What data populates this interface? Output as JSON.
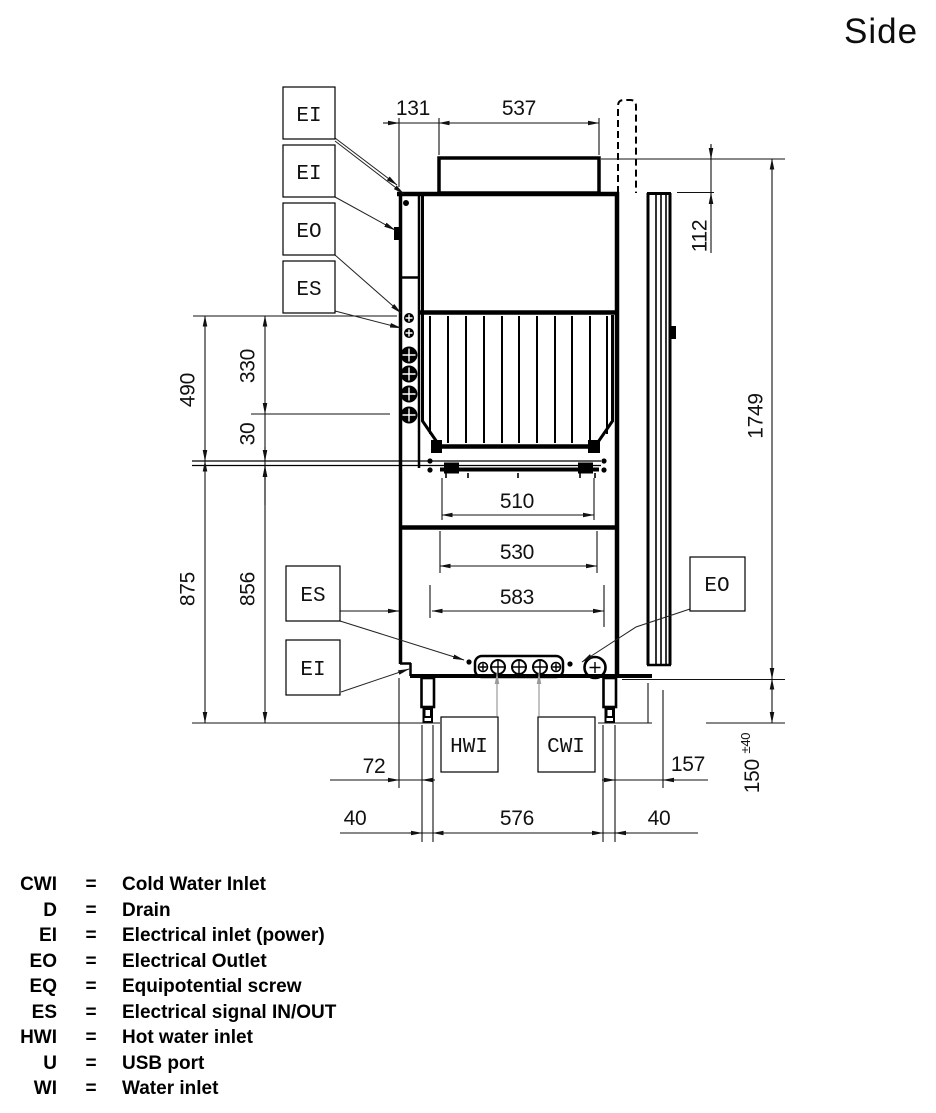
{
  "title": "Side",
  "dims": {
    "d131": "131",
    "d537": "537",
    "d112": "112",
    "d1749": "1749",
    "d490": "490",
    "d330": "330",
    "d30": "30",
    "d875": "875",
    "d856": "856",
    "d510": "510",
    "d530": "530",
    "d583": "583",
    "d107": "107",
    "d72": "72",
    "d157": "157",
    "d150": "150",
    "d150tol": "±40",
    "d40l": "40",
    "d576": "576",
    "d40r": "40"
  },
  "labels": {
    "ei_top_1": "EI",
    "ei_top_2": "EI",
    "eo_top": "EO",
    "es_top": "ES",
    "es_bottom": "ES",
    "ei_bottom": "EI",
    "eo_bottom": "EO",
    "hwi": "HWI",
    "cwi": "CWI"
  },
  "legend": {
    "separator": "=",
    "rows": [
      {
        "abbr": "CWI",
        "desc": "Cold Water Inlet"
      },
      {
        "abbr": "D",
        "desc": "Drain"
      },
      {
        "abbr": "EI",
        "desc": "Electrical inlet (power)"
      },
      {
        "abbr": "EO",
        "desc": "Electrical Outlet"
      },
      {
        "abbr": "EQ",
        "desc": "Equipotential screw"
      },
      {
        "abbr": "ES",
        "desc": "Electrical signal IN/OUT"
      },
      {
        "abbr": "HWI",
        "desc": "Hot water inlet"
      },
      {
        "abbr": "U",
        "desc": "USB port"
      },
      {
        "abbr": "WI",
        "desc": "Water inlet"
      }
    ]
  }
}
